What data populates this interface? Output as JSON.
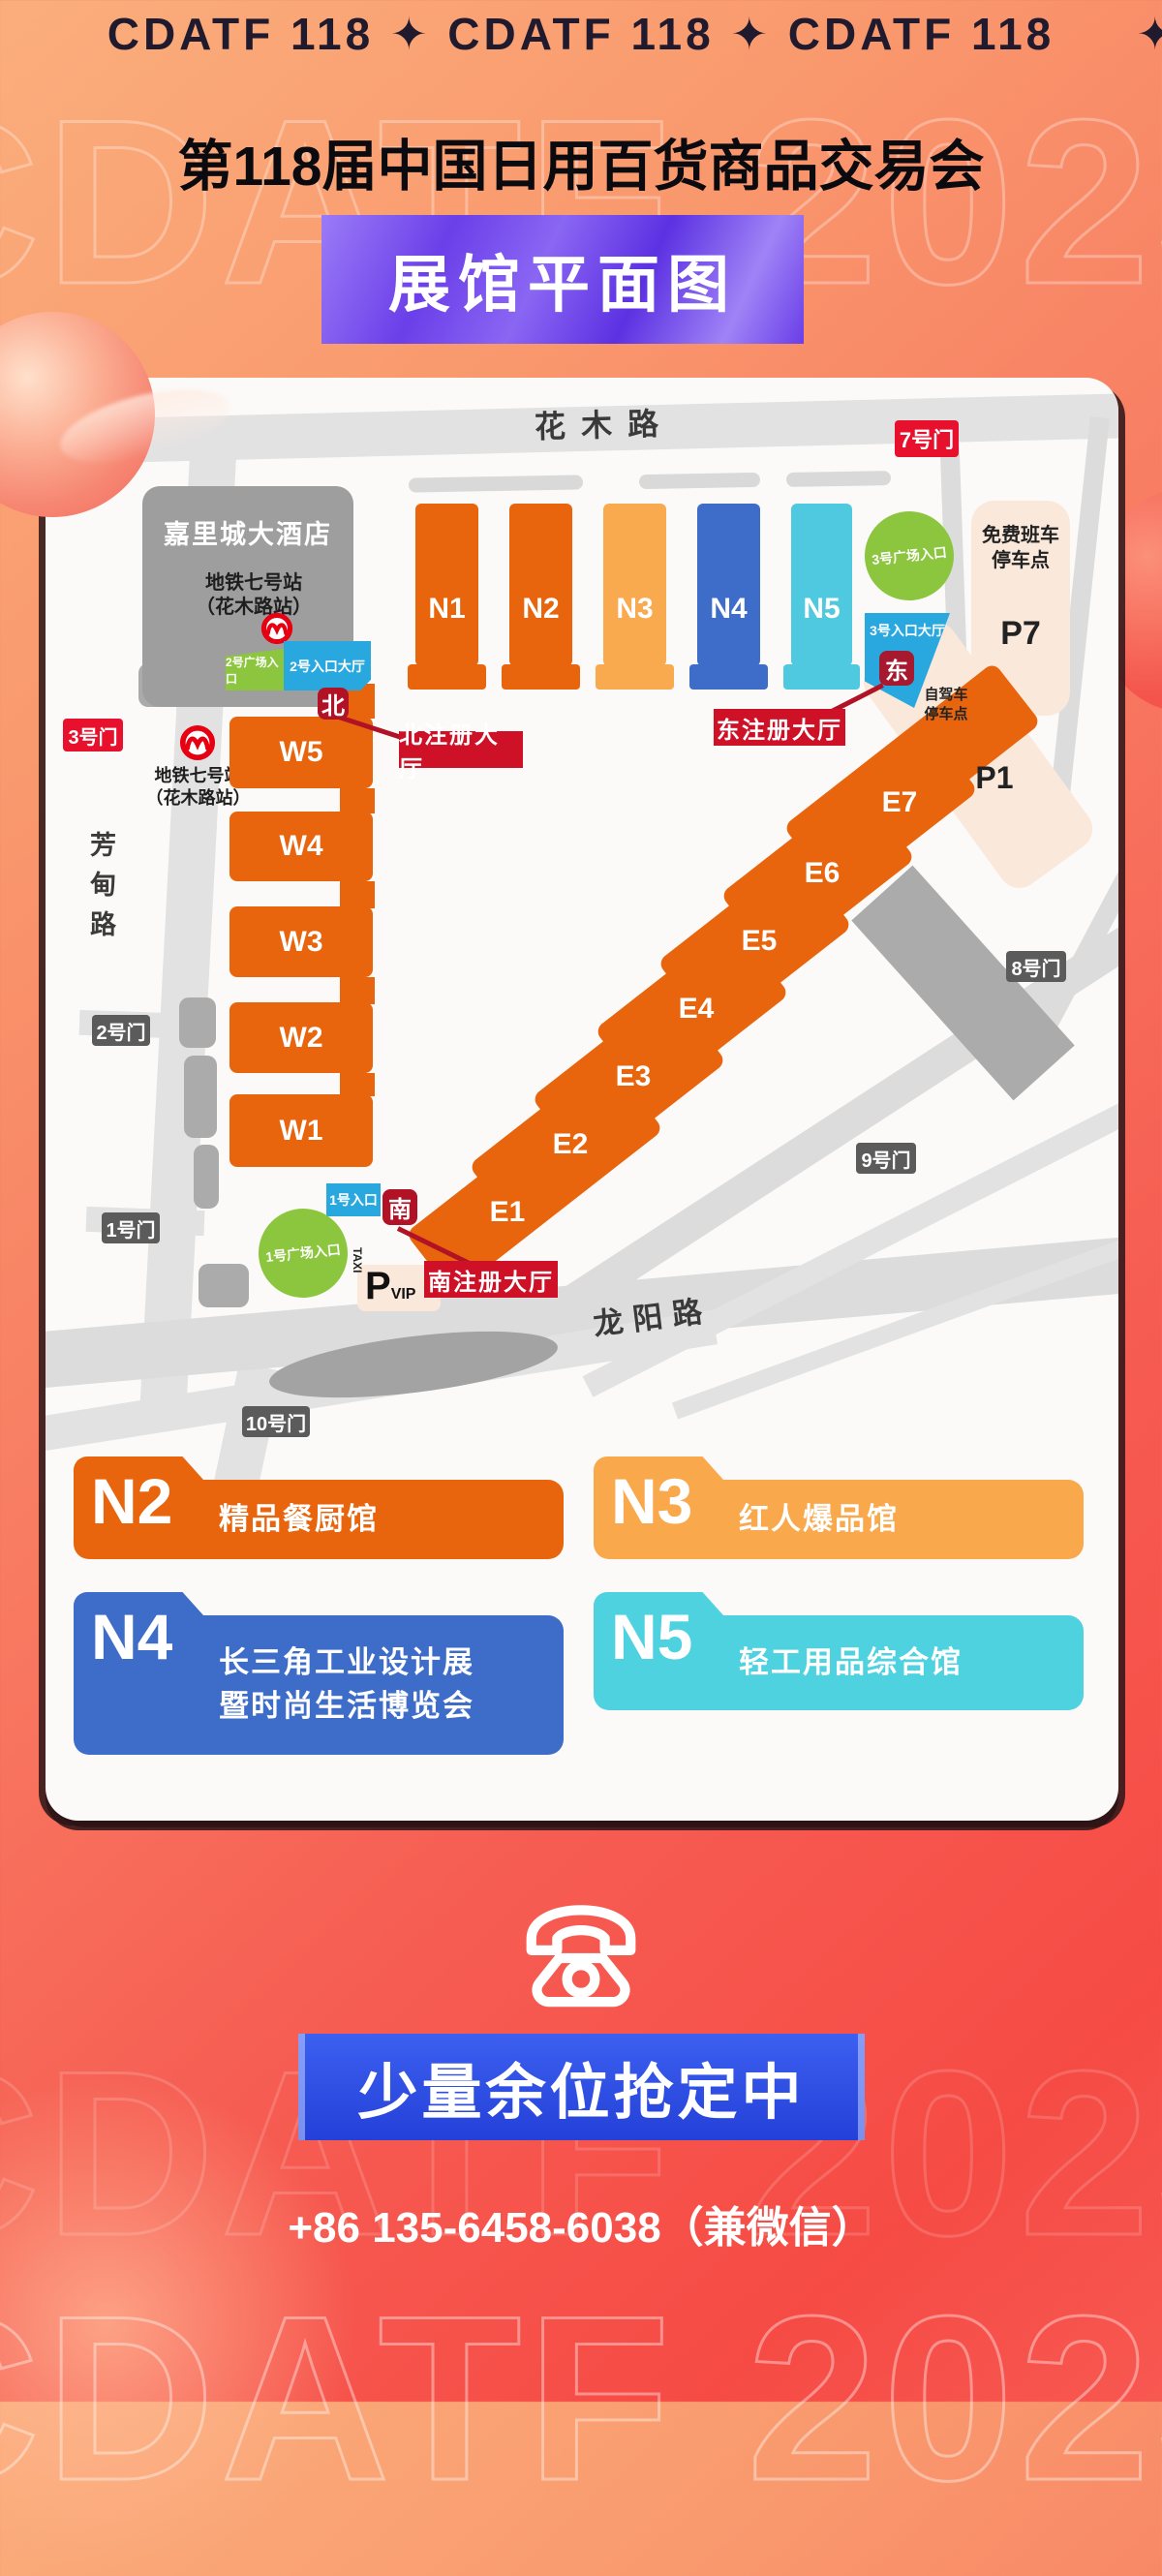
{
  "watermark": "CDATF 2025",
  "header": {
    "ticker": "CDATF 118 ✦ CDATF 118 ✦ CDATF 118",
    "star": "✦",
    "title": "第118届中国日用百货商品交易会",
    "banner": "展馆平面图"
  },
  "map": {
    "roads": {
      "huamu": "花木路",
      "fangdian": "芳甸路",
      "longyang": "龙阳路"
    },
    "hotel": {
      "name": "嘉里城大酒店",
      "metro_line1": "地铁七号站",
      "metro_line2": "（花木路站）"
    },
    "metro_station": {
      "line1": "地铁七号站",
      "line2": "（花木路站）"
    },
    "gates": {
      "gate1": "1号门",
      "gate2": "2号门",
      "gate3": "3号门",
      "gate7": "7号门",
      "gate8": "8号门",
      "gate9": "9号门",
      "gate10": "10号门"
    },
    "halls_n": [
      {
        "id": "N1",
        "color": "#E8650D"
      },
      {
        "id": "N2",
        "color": "#E8650D"
      },
      {
        "id": "N3",
        "color": "#F9A94E"
      },
      {
        "id": "N4",
        "color": "#3E6DC9"
      },
      {
        "id": "N5",
        "color": "#4FC9E0"
      }
    ],
    "halls_w": [
      "W5",
      "W4",
      "W3",
      "W2",
      "W1"
    ],
    "halls_e": [
      "E1",
      "E2",
      "E3",
      "E4",
      "E5",
      "E6",
      "E7"
    ],
    "labels": {
      "plaza2": "2号广场入口",
      "hall2": "2号入口大厅",
      "north": "北",
      "north_reg": "北注册大厅",
      "plaza3": "3号广场入口",
      "hall3": "3号入口大厅",
      "east": "东",
      "east_reg": "东注册大厅",
      "entrance1": "1号入口",
      "south": "南",
      "plaza1": "1号广场入口",
      "south_reg": "南注册大厅",
      "taxi": "TAXI",
      "p": "P",
      "vip": "VIP",
      "shuttle_line1": "免费班车",
      "shuttle_line2": "停车点",
      "p7": "P7",
      "p1": "P1",
      "selfdrive_line1": "自驾车",
      "selfdrive_line2": "停车点"
    }
  },
  "legend": [
    {
      "code": "N2",
      "line1": "精品餐厨馆",
      "line2": "",
      "color": "#E8650D"
    },
    {
      "code": "N3",
      "line1": "红人爆品馆",
      "line2": "",
      "color": "#F9A84C"
    },
    {
      "code": "N4",
      "line1": "长三角工业设计展",
      "line2": "暨时尚生活博览会",
      "color": "#3E6DC9"
    },
    {
      "code": "N5",
      "line1": "轻工用品综合馆",
      "line2": "",
      "color": "#4FD2E0"
    }
  ],
  "footer": {
    "cta": "少量余位抢定中",
    "phone": "+86 135-6458-6038（兼微信）"
  },
  "colors": {
    "accent_red": "#E8112D",
    "badge_dark_red": "#B11226",
    "reg_red": "#CE1126",
    "gate_gray": "#5B5B5B",
    "purple": "#6B3FE9",
    "cta_blue": "#2F53E0",
    "hall_orange": "#E8650D"
  }
}
